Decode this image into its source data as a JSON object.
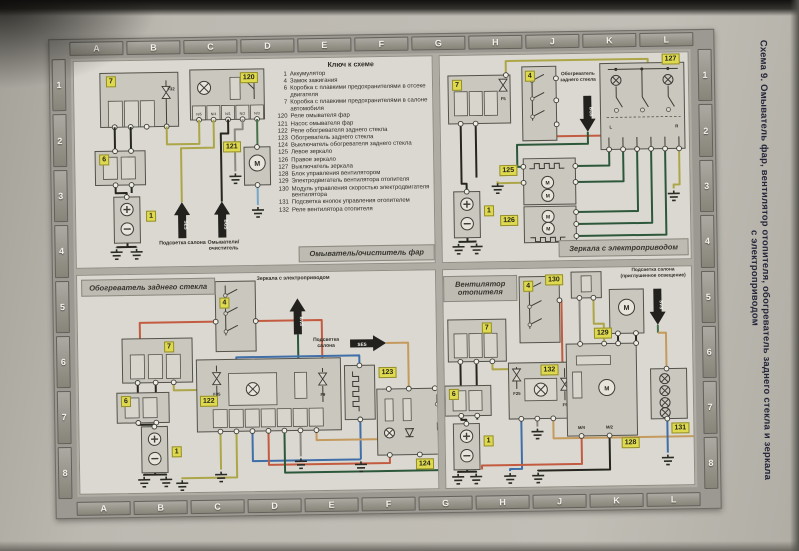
{
  "page": {
    "side_title": "Схема 9. Омыватель фар, вентилятор отопителя, обогреватель заднего стекла и зеркала",
    "side_title_line2": "с электроприводом",
    "grid_letters": [
      "A",
      "B",
      "C",
      "D",
      "E",
      "F",
      "G",
      "H",
      "J",
      "K",
      "L"
    ],
    "grid_numbers": [
      "1",
      "2",
      "3",
      "4",
      "5",
      "6",
      "7",
      "8"
    ]
  },
  "legend": {
    "title": "Ключ к схеме",
    "entries": [
      {
        "num": "1",
        "label": "Аккумулятор"
      },
      {
        "num": "4",
        "label": "Замок зажигания"
      },
      {
        "num": "6",
        "label": "Коробка с плавкими предохранителями в отсеке двигателя"
      },
      {
        "num": "7",
        "label": "Коробка с плавкими предохранителями в салоне автомобиля"
      },
      {
        "num": "120",
        "label": "Реле омывателя фар"
      },
      {
        "num": "121",
        "label": "Насос омывателя фар"
      },
      {
        "num": "122",
        "label": "Реле обогревателя заднего стекла"
      },
      {
        "num": "123",
        "label": "Обогреватель заднего стекла"
      },
      {
        "num": "124",
        "label": "Выключатель обогревателя заднего стекла"
      },
      {
        "num": "125",
        "label": "Левое зеркало"
      },
      {
        "num": "126",
        "label": "Правое зеркало"
      },
      {
        "num": "127",
        "label": "Выключатель зеркала"
      },
      {
        "num": "128",
        "label": "Блок управления вентилятором"
      },
      {
        "num": "129",
        "label": "Электродвигатель вентилятора отопителя"
      },
      {
        "num": "130",
        "label": "Модуль управления скоростью электродвигателя вентилятора"
      },
      {
        "num": "131",
        "label": "Подсветка кнопок управления отопителем"
      },
      {
        "num": "132",
        "label": "Реле вентилятора отопителя"
      }
    ]
  },
  "symbols": {
    "motor": "M"
  },
  "washer": {
    "caption": "Омыватель/очиститель фар",
    "fusebox_cabin": "7",
    "fuse": "F32",
    "relay": "120",
    "pump": "121",
    "fusebox_engine": "6",
    "battery": "1",
    "terminals": [
      "N/5",
      "N/4",
      "N/1",
      "N/2",
      "N/3"
    ],
    "arrow1_code": "SES",
    "arrow1_label": "Подсветка салона",
    "arrow2_code": "BGS",
    "arrow2_label": "Омыватели/очиститель"
  },
  "mirrors": {
    "caption": "Зеркала с электроприводом",
    "fusebox_cabin": "7",
    "fuse": "F5",
    "ignition": "4",
    "switch": "127",
    "mirror_left": "125",
    "mirror_right": "126",
    "battery": "1",
    "left_label": "L",
    "right_label": "R",
    "arrow_code": "BG5",
    "arrow_label": "Обогреватель заднего стекла"
  },
  "rear_heater": {
    "caption": "Обогреватель заднего стекла",
    "ignition": "4",
    "fusebox_cabin": "7",
    "fusebox_engine": "6",
    "battery": "1",
    "relay": "122",
    "fuse1": "F35",
    "fuse2": "F9",
    "heater": "123",
    "switch": "124",
    "arrow_mirrors_code": "BVS",
    "arrow_mirrors_label": "Зеркала с электроприводом",
    "arrow_cabin_code": "SES",
    "arrow_cabin_label": "Подсветка салона"
  },
  "fan": {
    "caption": "Вентилятор отопителя",
    "ignition": "4",
    "fusebox_cabin": "7",
    "fusebox_engine": "6",
    "battery": "1",
    "relay": "132",
    "fuse1": "F25",
    "fuse2": "F9",
    "module": "130",
    "motor": "129",
    "control": "128",
    "illumination": "131",
    "m4_label": "M/4",
    "m2_label": "M/2",
    "arrow_code": "SVS",
    "arrow_label": "Подсветка салона (приглушенное освещение)"
  }
}
